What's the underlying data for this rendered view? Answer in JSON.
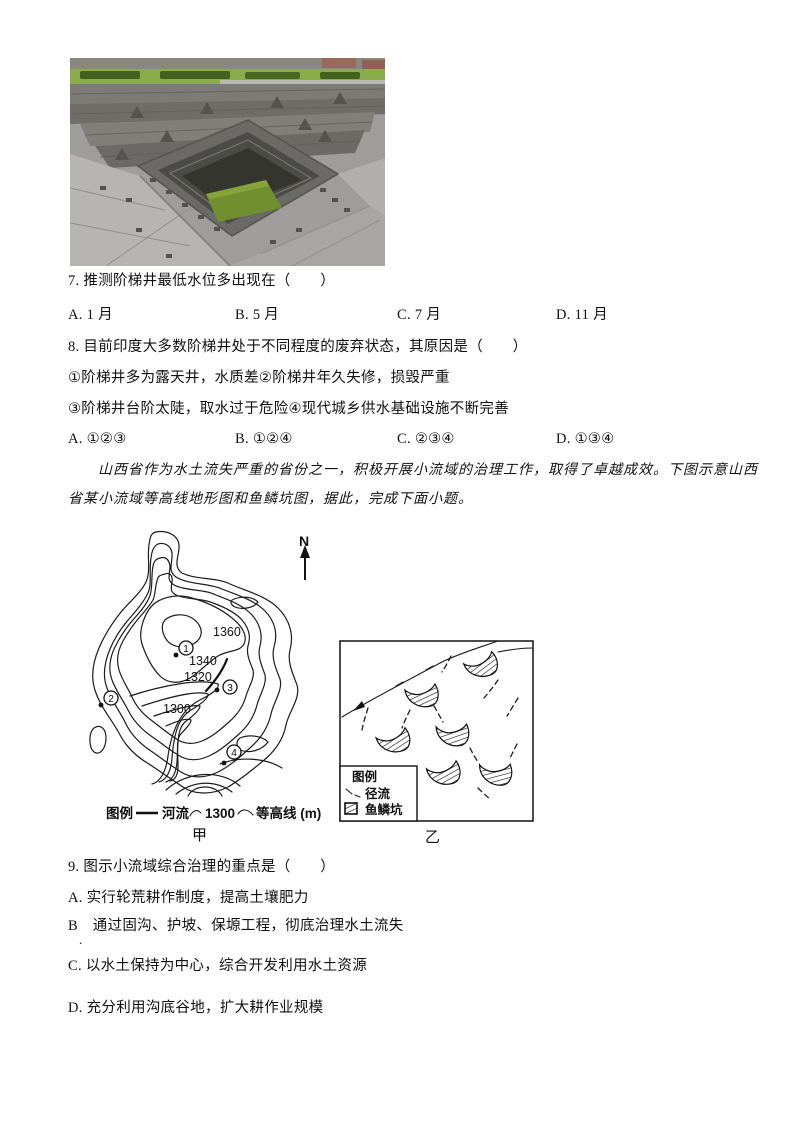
{
  "photo": {
    "description": "stepwell-photo",
    "colors": {
      "stone": "#9e9d9b",
      "pit": "#35352f",
      "water": "#708f2f",
      "grass": "#8aad49",
      "hedge": "#44611f"
    }
  },
  "q7": {
    "stem": "7. 推测阶梯井最低水位多出现在（　　）",
    "options": [
      "A. 1 月",
      "B. 5 月",
      "C. 7 月",
      "D. 11 月"
    ]
  },
  "q8": {
    "stem": "8. 目前印度大多数阶梯井处于不同程度的废弃状态，其原因是（　　）",
    "items": [
      "①阶梯井多为露天井，水质差②阶梯井年久失修，损毁严重",
      "③阶梯井台阶太陡，取水过于危险④现代城乡供水基础设施不断完善"
    ],
    "options": [
      "A. ①②③",
      "B. ①②④",
      "C. ②③④",
      "D. ①③④"
    ]
  },
  "passage": {
    "full": "山西省作为水土流失严重的省份之一，积极开展小流域的治理工作，取得了卓越成效。下图示意山西省某小流域等高线地形图和鱼鳞坑图，据此，完成下面小题。",
    "line1": "　　山西省作为水土流失严重的省份之一，积极开展小流域的治理工作，取得了卓越成效。下图示意山西",
    "line2": "省某小流域等高线地形图和鱼鳞坑图，据此，完成下面小题。"
  },
  "map": {
    "north": "N",
    "labels": {
      "c1360": "1360",
      "c1340": "1340",
      "c1320": "1320",
      "c1300": "1300"
    },
    "points": {
      "p1": "1",
      "p2": "2",
      "p3": "3",
      "p4": "4"
    },
    "legend": {
      "title": "图例",
      "river": "河流",
      "contour_value": "1300",
      "contour": "等高线 (m)"
    },
    "caption": "甲"
  },
  "fishscale": {
    "legend": {
      "title": "图例",
      "runoff": "径流",
      "pit": "鱼鳞坑"
    },
    "caption": "乙"
  },
  "q9": {
    "stem": "9. 图示小流域综合治理的重点是（　　）",
    "options": [
      "A. 实行轮荒耕作制度，提高土壤肥力",
      "B　通过固沟、护坡、保塬工程，彻底治理水土流失",
      "C. 以水土保持为中心，综合开发利用水土资源",
      "D. 充分利用沟底谷地，扩大耕作业规模"
    ],
    "stray_mark": "."
  }
}
